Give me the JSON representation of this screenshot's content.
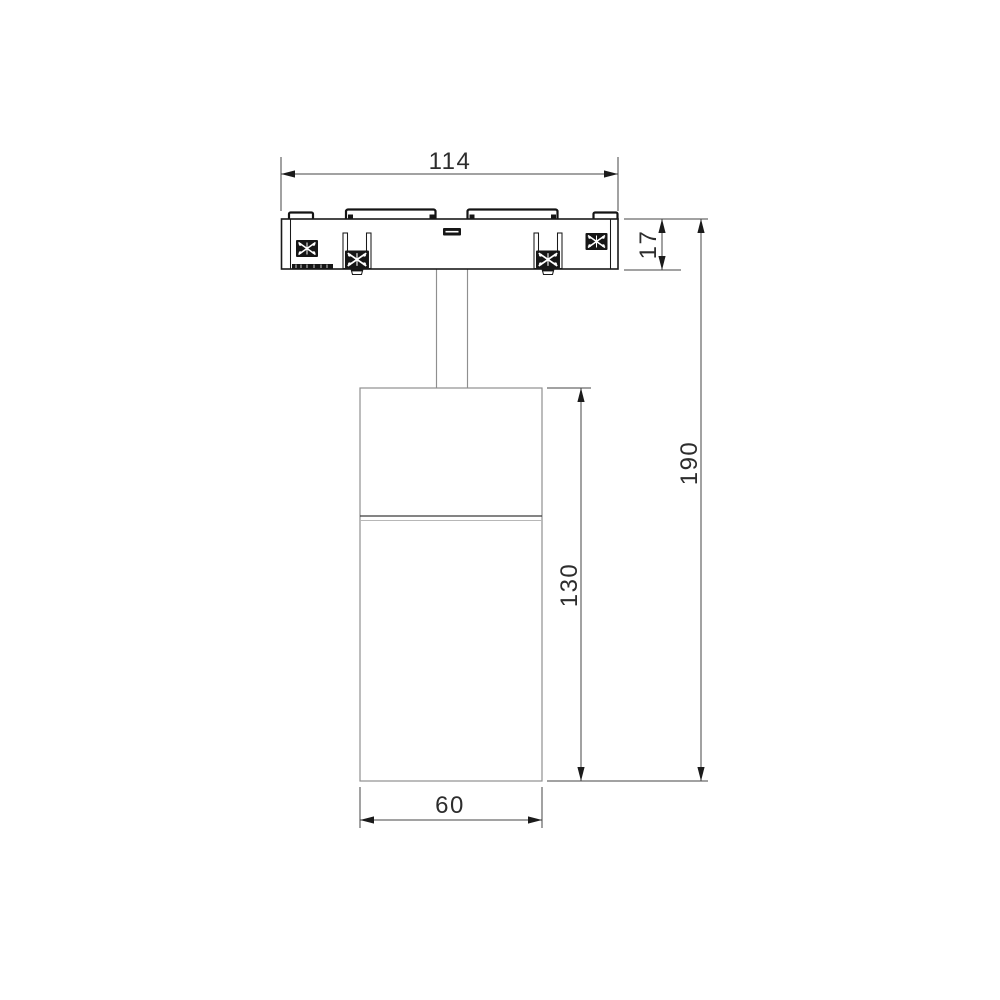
{
  "drawing": {
    "kind": "technical-dimension-drawing",
    "dims": {
      "base_width": "114",
      "base_height": "17",
      "total_height": "190",
      "body_height": "130",
      "body_width": "60"
    },
    "colors": {
      "background": "#ffffff",
      "outline_dark": "#1a1a1a",
      "outline_light": "#8f8f8f",
      "dimension": "#454545"
    }
  }
}
